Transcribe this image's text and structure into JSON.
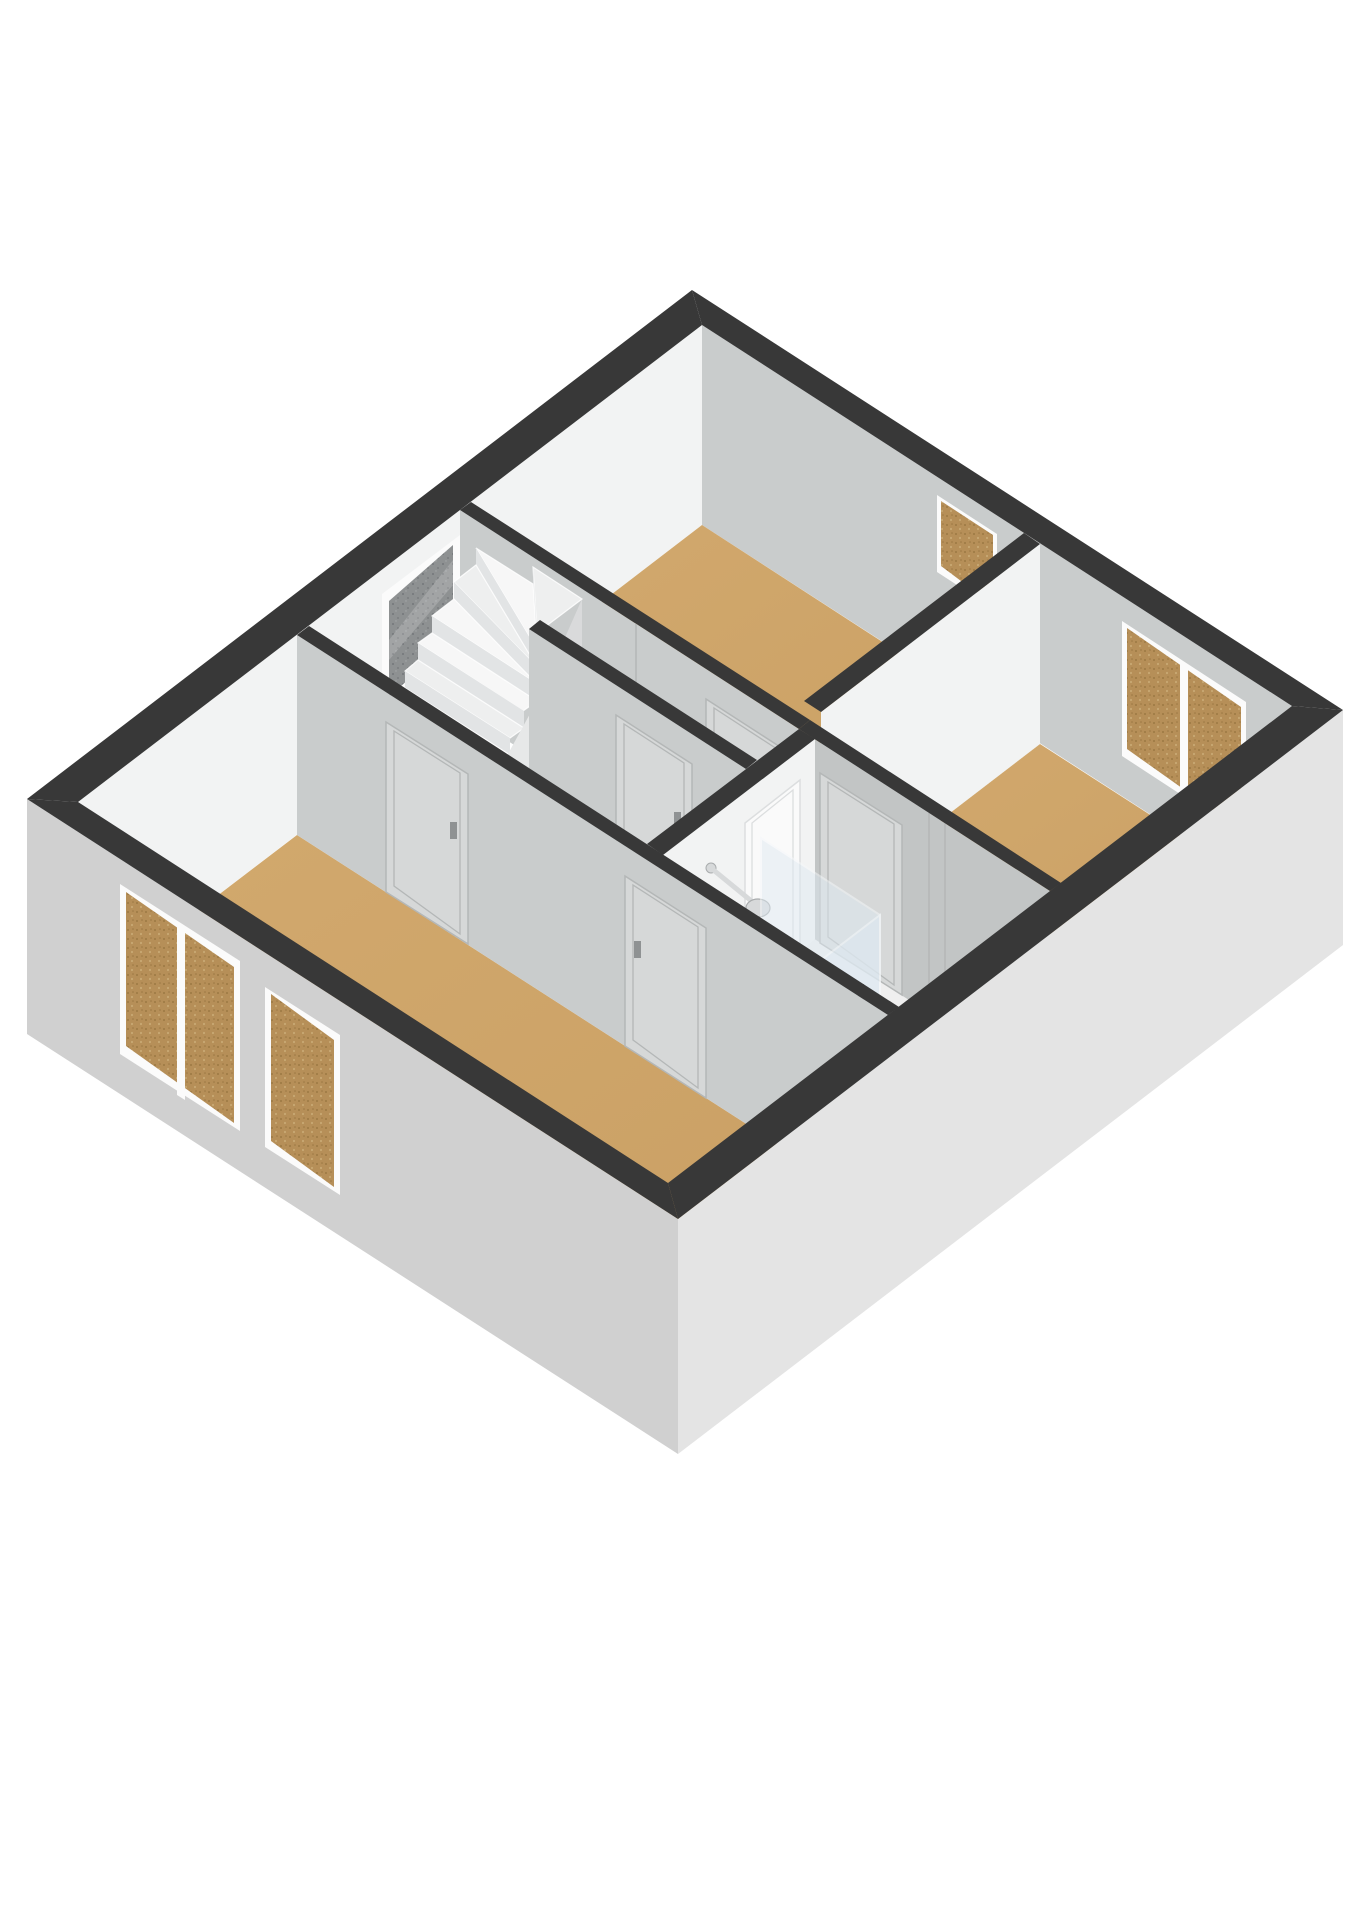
{
  "scene": {
    "type": "3d-floorplan-axonometric-render",
    "background": "#ffffff",
    "floor_shown": "upper floor with staircase, three bedrooms, hallway and bathroom"
  },
  "colors": {
    "background": "#ffffff",
    "wall-top": "#383838",
    "wall-face-bright": "#f2f3f3",
    "wall-face-gray": "#c9cccc",
    "wall-face-gray-dark": "#c2c5c5",
    "ext-outer-left": "#d0d0d0",
    "ext-outer-right": "#e4e4e4",
    "floor-wood": "#d2a96e",
    "floor-wood-deep": "#c99f63",
    "floor-bath": "#efefef",
    "shower-tray": "#c3ced9",
    "tray-rim": "#f4f6f8",
    "glass": "#dfeaf2",
    "glass-edge": "#f5f8fa",
    "frame-white": "#fbfbfb",
    "cork-base": "#b68f58",
    "cork-dot-dark": "#9c7843",
    "cork-dot-light": "#c8a873",
    "darkglass-base": "#8e9192",
    "darkglass-dot": "#74777a",
    "tread": "#f7f7f7",
    "tread-alt": "#eeefef",
    "riser": "#e2e4e5",
    "stringer": "#e7e8e8",
    "under-stair": "#d9dadb",
    "door-leaf-on-gray": "#d6d8d8",
    "door-seam-on-gray": "#b4b7b7",
    "door-leaf-on-bright": "#fafafa",
    "door-seam-on-bright": "#dcdedf",
    "chrome": "#d7d9da",
    "chrome-dark": "#a9acad",
    "handle": "#8f9293"
  },
  "objects": {
    "rooms": [
      {
        "name": "bedroom-top",
        "floor": "wood"
      },
      {
        "name": "bedroom-right",
        "floor": "wood"
      },
      {
        "name": "bedroom-bottom",
        "floor": "wood"
      },
      {
        "name": "hallway-landing",
        "floor": "wood"
      },
      {
        "name": "corridor-closet",
        "floor": "wood"
      },
      {
        "name": "bathroom",
        "floor": "white"
      }
    ],
    "fixtures": [
      {
        "name": "winder-staircase",
        "steps_visible": 11
      },
      {
        "name": "shower-tray"
      },
      {
        "name": "shower-glass-panels",
        "count": 2
      },
      {
        "name": "shower-head-wall-mounted"
      },
      {
        "name": "shower-control"
      }
    ],
    "windows": [
      {
        "name": "stair-window",
        "wall": "upper-left",
        "glazing": "dark"
      },
      {
        "name": "bedroom-top-window",
        "wall": "upper-right",
        "glazing": "cork"
      },
      {
        "name": "bedroom-right-window",
        "wall": "upper-right",
        "panes": 2,
        "glazing": "cork"
      },
      {
        "name": "bedroom-bottom-window-double",
        "wall": "lower-left",
        "panes": 2,
        "glazing": "cork"
      },
      {
        "name": "bedroom-bottom-window-narrow",
        "wall": "lower-left",
        "glazing": "cork"
      }
    ],
    "doors": [
      {
        "name": "door-bedroom-top"
      },
      {
        "name": "door-corridor",
        "handle": true
      },
      {
        "name": "door-bedroom-right"
      },
      {
        "name": "door-bathroom"
      },
      {
        "name": "door-bedroom-bottom-1",
        "handle": true
      },
      {
        "name": "door-bedroom-bottom-2",
        "handle": true
      },
      {
        "name": "shower-glass-door",
        "handle": true
      }
    ]
  }
}
